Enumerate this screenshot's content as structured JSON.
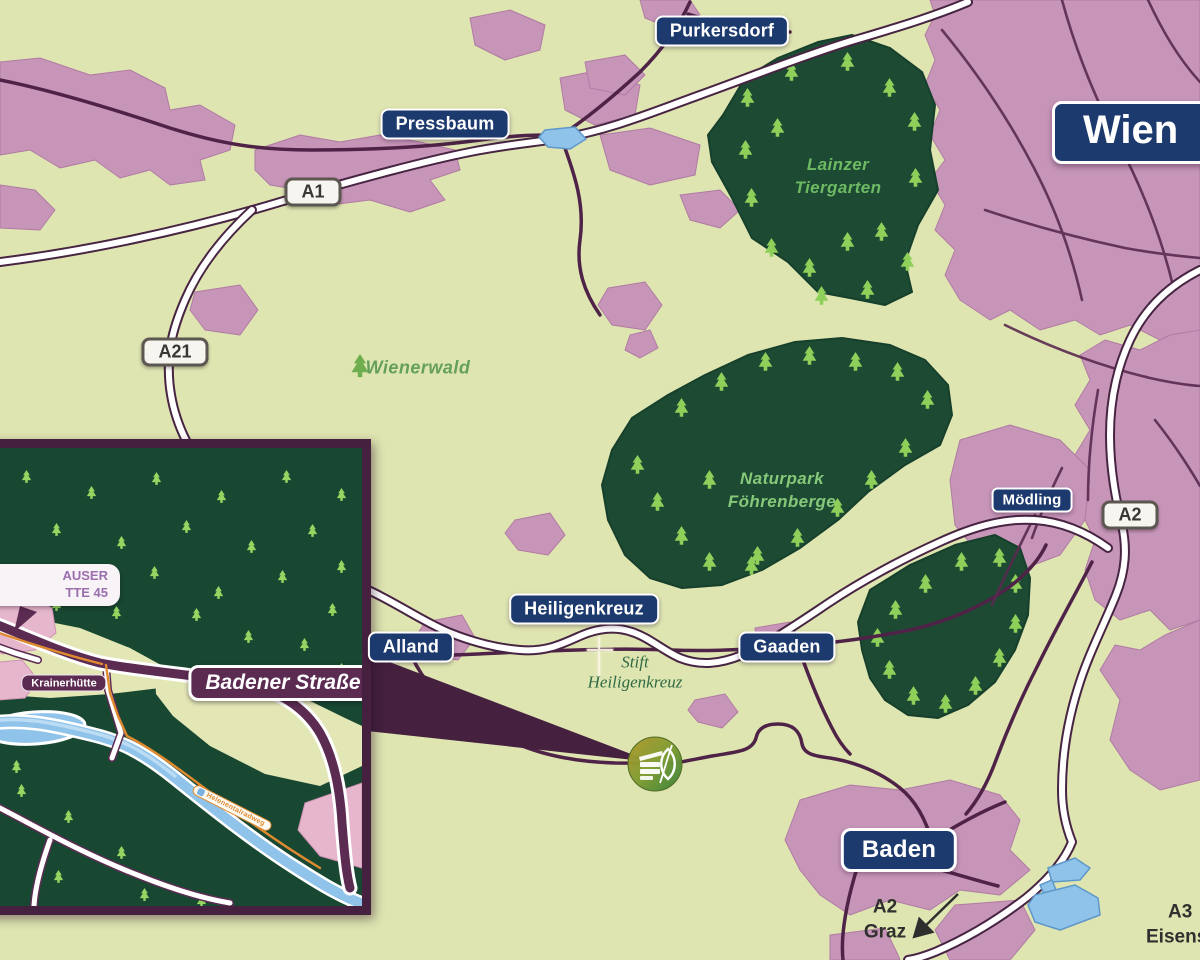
{
  "map": {
    "city_sign": "Wien",
    "towns": {
      "purkersdorf": "Purkersdorf",
      "pressbaum": "Pressbaum",
      "moedling": "Mödling",
      "heiligenkreuz": "Heiligenkreuz",
      "alland": "Alland",
      "gaaden": "Gaaden",
      "baden": "Baden"
    },
    "shields": {
      "a1": "A1",
      "a21": "A21",
      "a2": "A2"
    },
    "regions": {
      "wienerwald": "Wienerwald",
      "lainzer_line1": "Lainzer",
      "lainzer_line2": "Tiergarten",
      "naturpark_line1": "Naturpark",
      "naturpark_line2": "Föhrenberge",
      "stift_line1": "Stift",
      "stift_line2": "Heiligenkreuz"
    },
    "directions": {
      "graz_line1": "A2",
      "graz_line2": "Graz",
      "eisenstadt_line1": "A3",
      "eisenstadt_line2": "Eisenstadt"
    }
  },
  "inset": {
    "address_line1": "AUSER",
    "address_line2": "TTE 45",
    "street_label": "Badener Straße",
    "hotel_label": "Krainerhütte",
    "trail_label": "Helenentalradweg"
  },
  "icons": {
    "tree": "pine-tree-icon",
    "cross": "monastery-cross-icon",
    "marker": "hotel-logo-marker",
    "arrow": "direction-arrow-icon"
  },
  "colors": {
    "land": "#dfe5b1",
    "urban_pink": "#c795b8",
    "forest_green": "#1d4a33",
    "tree_green": "#8ed05a",
    "sign_navy": "#1d3a6e",
    "road_purple": "#4f2347",
    "label_purple": "#5b2b52",
    "water_blue": "#8fc3ea",
    "trail_orange": "#e08a30"
  }
}
